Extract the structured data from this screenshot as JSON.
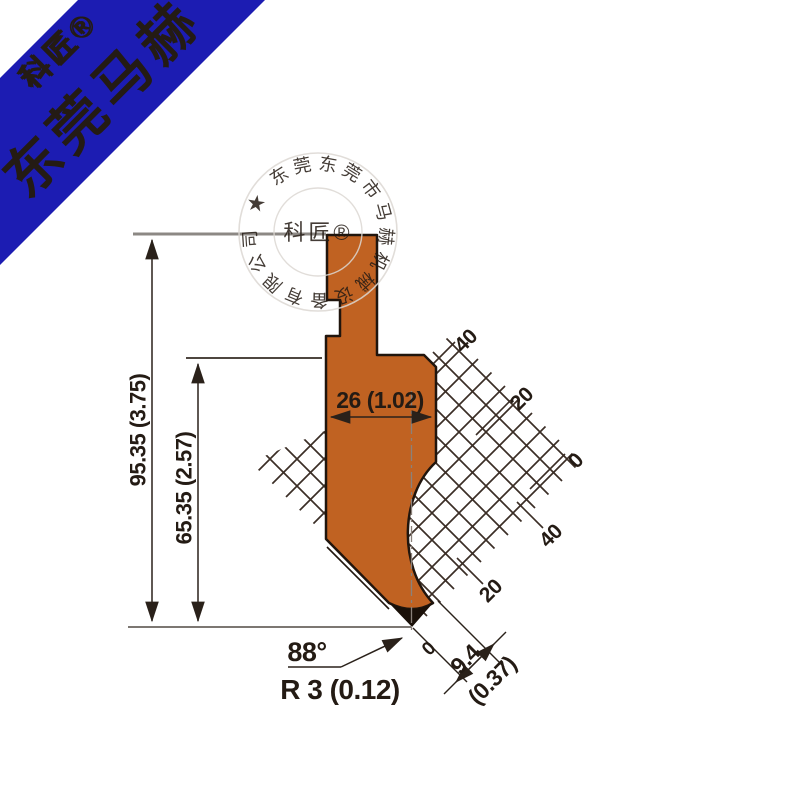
{
  "banner": {
    "brand_registered": "科匠®",
    "brand_main": "东莞马赫",
    "colors": {
      "background": "#1c1cb2",
      "main_text": "#e50139",
      "embossed_text": "#0d0d93"
    }
  },
  "watermark": {
    "ring_text": "东莞市马赫机械设备有限公司 ★ 东莞市马赫机械设备有限公司",
    "center_text": "科匠®"
  },
  "drawing": {
    "type": "press-brake punch tool profile (technical drawing)",
    "dimensions": {
      "total_height": "95.35 (3.75)",
      "shoulder_height": "65.35 (2.57)",
      "body_width": "26 (1.02)",
      "tip_angle": "88°",
      "tip_radius": "R 3 (0.12)",
      "tip_offset_zero": "0",
      "tip_offset_mm": "9.4",
      "tip_offset_inch": "(0.37)"
    },
    "scale_labels": {
      "upper": [
        "40",
        "20",
        "0"
      ],
      "lower": [
        "40",
        "20"
      ]
    },
    "colors": {
      "tool_fill": "#c06222",
      "outline": "#20150d",
      "hatch": "#3b2e26",
      "reference_line": "#8c8884"
    }
  }
}
